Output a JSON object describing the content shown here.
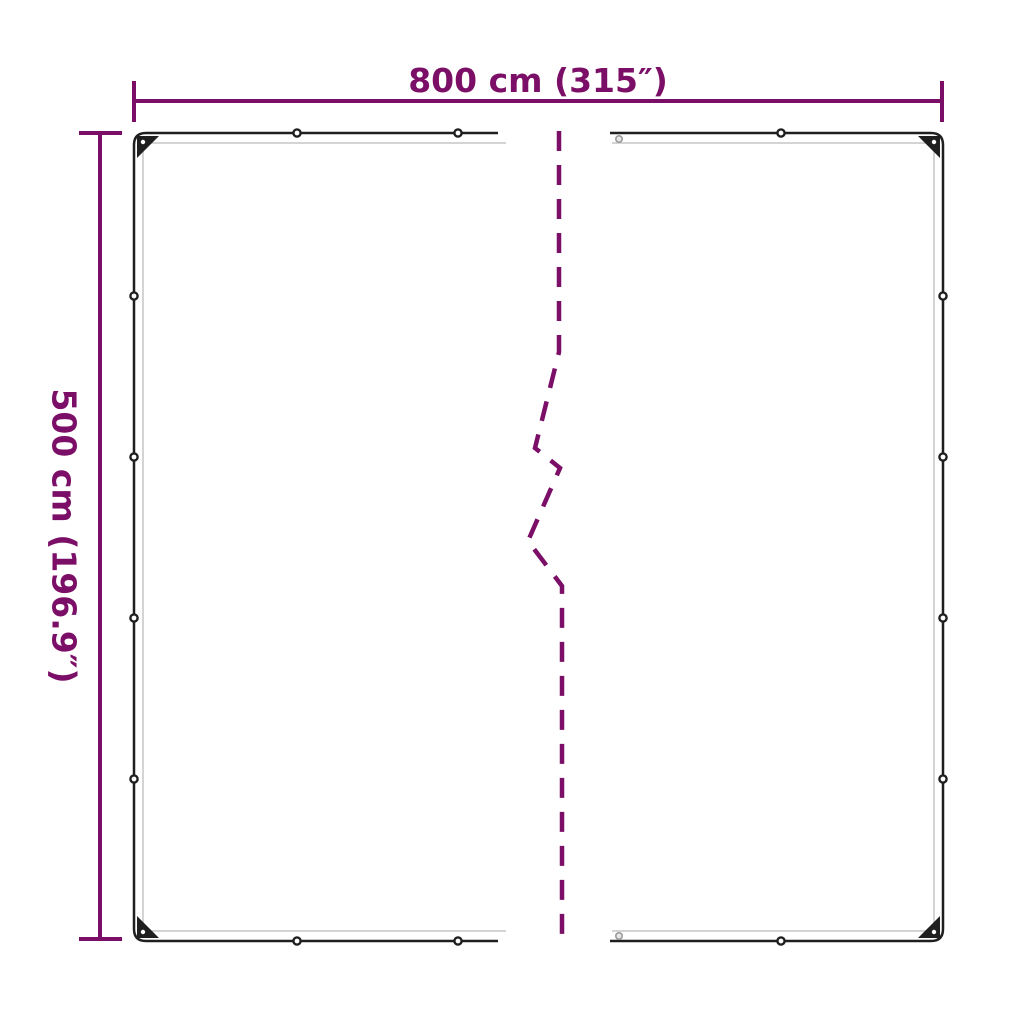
{
  "colors": {
    "accent": "#7B0E66",
    "outline": "#1f1f1f",
    "hem": "#c6c6c6",
    "grommet": "#1f1f1f",
    "background": "#ffffff"
  },
  "dimensions": {
    "width_label": "800 cm (315″)",
    "height_label": "500 cm (196.9″)"
  }
}
